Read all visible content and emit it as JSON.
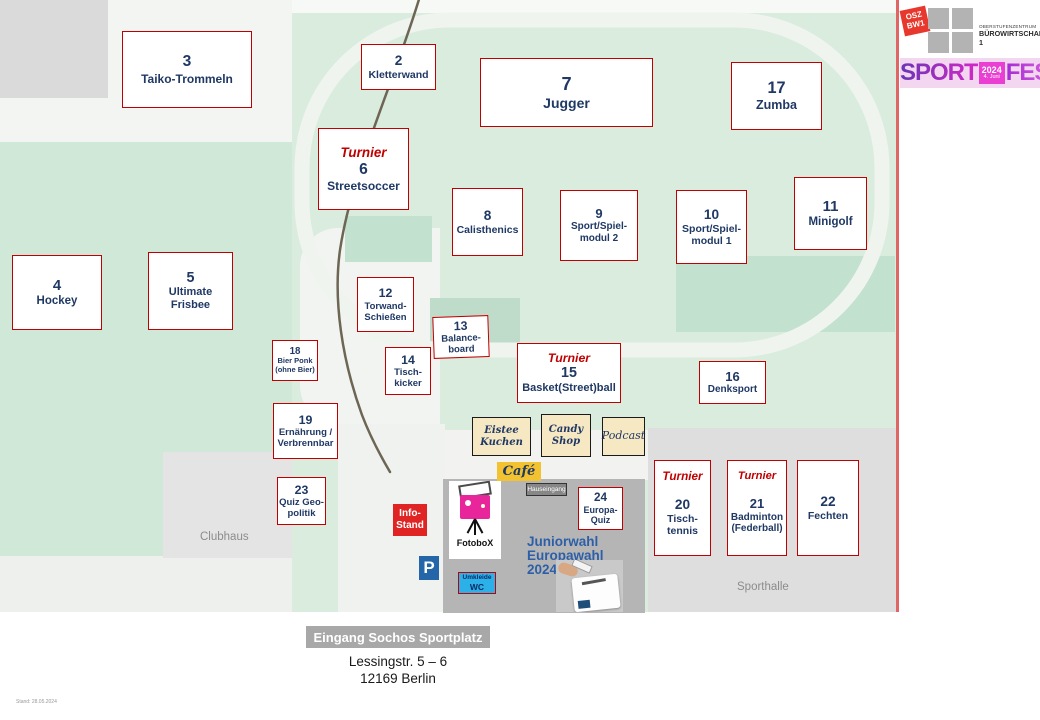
{
  "title_block": {
    "logo_square_line1": "OSZ",
    "logo_square_line2": "BW1",
    "org_line1": "OBERSTUFENZENTRUM",
    "org_line2": "BÜROWIRTSCHAFT 1",
    "banner_sport": "SPORT",
    "banner_year": "2024",
    "banner_date": "4. Juni",
    "banner_fest": "FEST"
  },
  "stations": [
    {
      "num": "3",
      "lines": [
        "Taiko-Trommeln"
      ]
    },
    {
      "num": "2",
      "lines": [
        "Kletterwand"
      ]
    },
    {
      "num": "7",
      "lines": [
        "Jugger"
      ]
    },
    {
      "num": "17",
      "lines": [
        "Zumba"
      ]
    },
    {
      "num": "6",
      "lines": [
        "Streetsoccer"
      ],
      "turnier": "Turnier"
    },
    {
      "num": "8",
      "lines": [
        "Calisthenics"
      ]
    },
    {
      "num": "9",
      "lines": [
        "Sport/Spiel-",
        "modul 2"
      ]
    },
    {
      "num": "10",
      "lines": [
        "Sport/Spiel-",
        "modul 1"
      ]
    },
    {
      "num": "11",
      "lines": [
        "Minigolf"
      ]
    },
    {
      "num": "4",
      "lines": [
        "Hockey"
      ]
    },
    {
      "num": "5",
      "lines": [
        "Ultimate",
        "Frisbee"
      ]
    },
    {
      "num": "12",
      "lines": [
        "Torwand-",
        "Schießen"
      ]
    },
    {
      "num": "13",
      "lines": [
        "Balance-",
        "board"
      ]
    },
    {
      "num": "14",
      "lines": [
        "Tisch-",
        "kicker"
      ]
    },
    {
      "num": "18",
      "lines": [
        "Bier Ponk",
        "(ohne Bier)"
      ]
    },
    {
      "num": "15",
      "lines": [
        "Basket(Street)ball"
      ],
      "turnier": "Turnier"
    },
    {
      "num": "16",
      "lines": [
        "Denksport"
      ]
    },
    {
      "num": "19",
      "lines": [
        "Ernährung /",
        "Verbrennbar"
      ]
    },
    {
      "num": "23",
      "lines": [
        "Quiz Geo-",
        "politik"
      ]
    },
    {
      "num": "24",
      "lines": [
        "Europa-",
        "Quiz"
      ]
    },
    {
      "num": "20",
      "lines": [
        "Tisch-",
        "tennis"
      ],
      "turnier": "Turnier"
    },
    {
      "num": "21",
      "lines": [
        "Badminton",
        "(Federball)"
      ],
      "turnier": "Turnier"
    },
    {
      "num": "22",
      "lines": [
        "Fechten"
      ]
    }
  ],
  "stands": {
    "eistee_line1": "Eistee",
    "eistee_line2": "Kuchen",
    "candy_line1": "Candy",
    "candy_line2": "Shop",
    "podcast": "Podcast",
    "cafe": "Café"
  },
  "labels": {
    "hauseingang": "Hauseingang",
    "info_line1": "Info-",
    "info_line2": "Stand",
    "parking": "P",
    "fotobox": "FotoboX",
    "juniorwahl_line1": "Juniorwahl",
    "juniorwahl_line2": "Europawahl",
    "juniorwahl_line3": "2024",
    "umkleide_line1": "Umkleide",
    "umkleide_line2": "WC",
    "clubhaus": "Clubhaus",
    "sporthalle": "Sporthalle",
    "entrance_badge": "Eingang Sochos Sportplatz",
    "address_line1": "Lessingstr. 5 – 6",
    "address_line2": "12169 Berlin",
    "footnote": "Stand: 28.05.2024"
  },
  "colors": {
    "station_border": "#c00000",
    "station_text": "#1f3864",
    "turnier_red": "#c00000",
    "stand_bg": "#f7e8c4",
    "cafe_bg": "#f2c230",
    "info_bg": "#e02424",
    "field_green": "#d9ecde",
    "left_field_green": "#cfe8d7",
    "panel_gray": "#b5b5b5",
    "brand_magenta": "#d428c8",
    "umkleide_blue": "#2bb0e8",
    "parking_blue": "#2566a8"
  }
}
